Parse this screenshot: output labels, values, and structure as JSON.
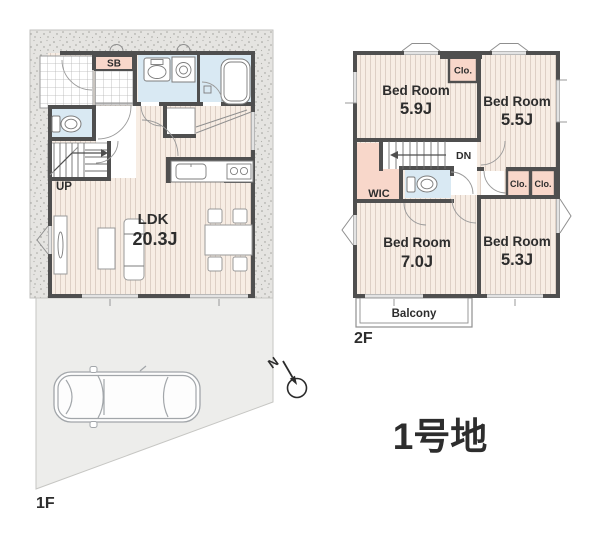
{
  "lot_title": "1号地",
  "compass": {
    "north_label": "N"
  },
  "floor1": {
    "label": "1F",
    "shoe_box_label": "SB",
    "stairs_label": "UP",
    "ldk": {
      "name": "LDK",
      "size": "20.3J"
    }
  },
  "floor2": {
    "label": "2F",
    "stairs_label": "DN",
    "wic_label": "WIC",
    "balcony_label": "Balcony",
    "closets": {
      "top": "Clo.",
      "mid_left": "Clo.",
      "mid_right": "Clo."
    },
    "bedrooms": {
      "top_left": {
        "name": "Bed Room",
        "size": "5.9J"
      },
      "top_right": {
        "name": "Bed Room",
        "size": "5.5J"
      },
      "bottom_left": {
        "name": "Bed Room",
        "size": "7.0J"
      },
      "bottom_right": {
        "name": "Bed Room",
        "size": "5.3J"
      }
    }
  },
  "colors": {
    "wall": "#4f4f4f",
    "floor_wood": "#f7ede4",
    "floor_stripe": "#ddcfc5",
    "wet_area": "#d9e9f3",
    "closet_pink": "#f8d7ca",
    "gravel": "#e5e4e1",
    "parking": "#ededeb",
    "text": "#2d2d2d"
  }
}
